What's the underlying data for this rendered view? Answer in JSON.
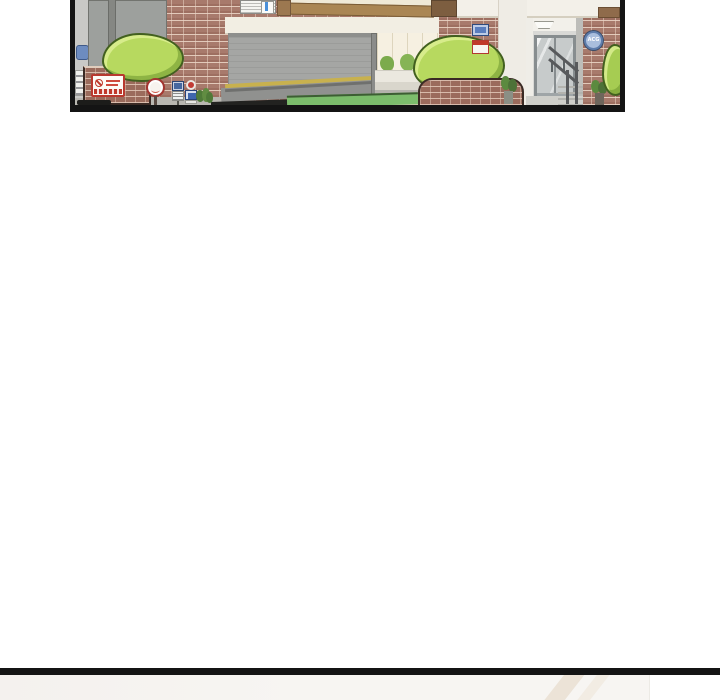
{
  "comic": {
    "panel1_alt": "building entrance exterior",
    "emblem_label": "ACG",
    "palette": {
      "page_bg": "#ffffff",
      "panel_border": "#141414",
      "brick": "#a87a6c",
      "mortar": "#e9d3c4",
      "shutter_gray": "#a5a6a4",
      "header_band": "#f2eee3",
      "wood_beam": "#aa8654",
      "bush_green": "#b7d95f",
      "grass_green": "#7cbd6c",
      "sign_red": "#c0392b",
      "sign_blue": "#4a6db3",
      "emblem_blue": "#5d7cab",
      "next_panel_bg": "#f7f5f2",
      "next_panel_streak": "#ece3d7"
    }
  }
}
